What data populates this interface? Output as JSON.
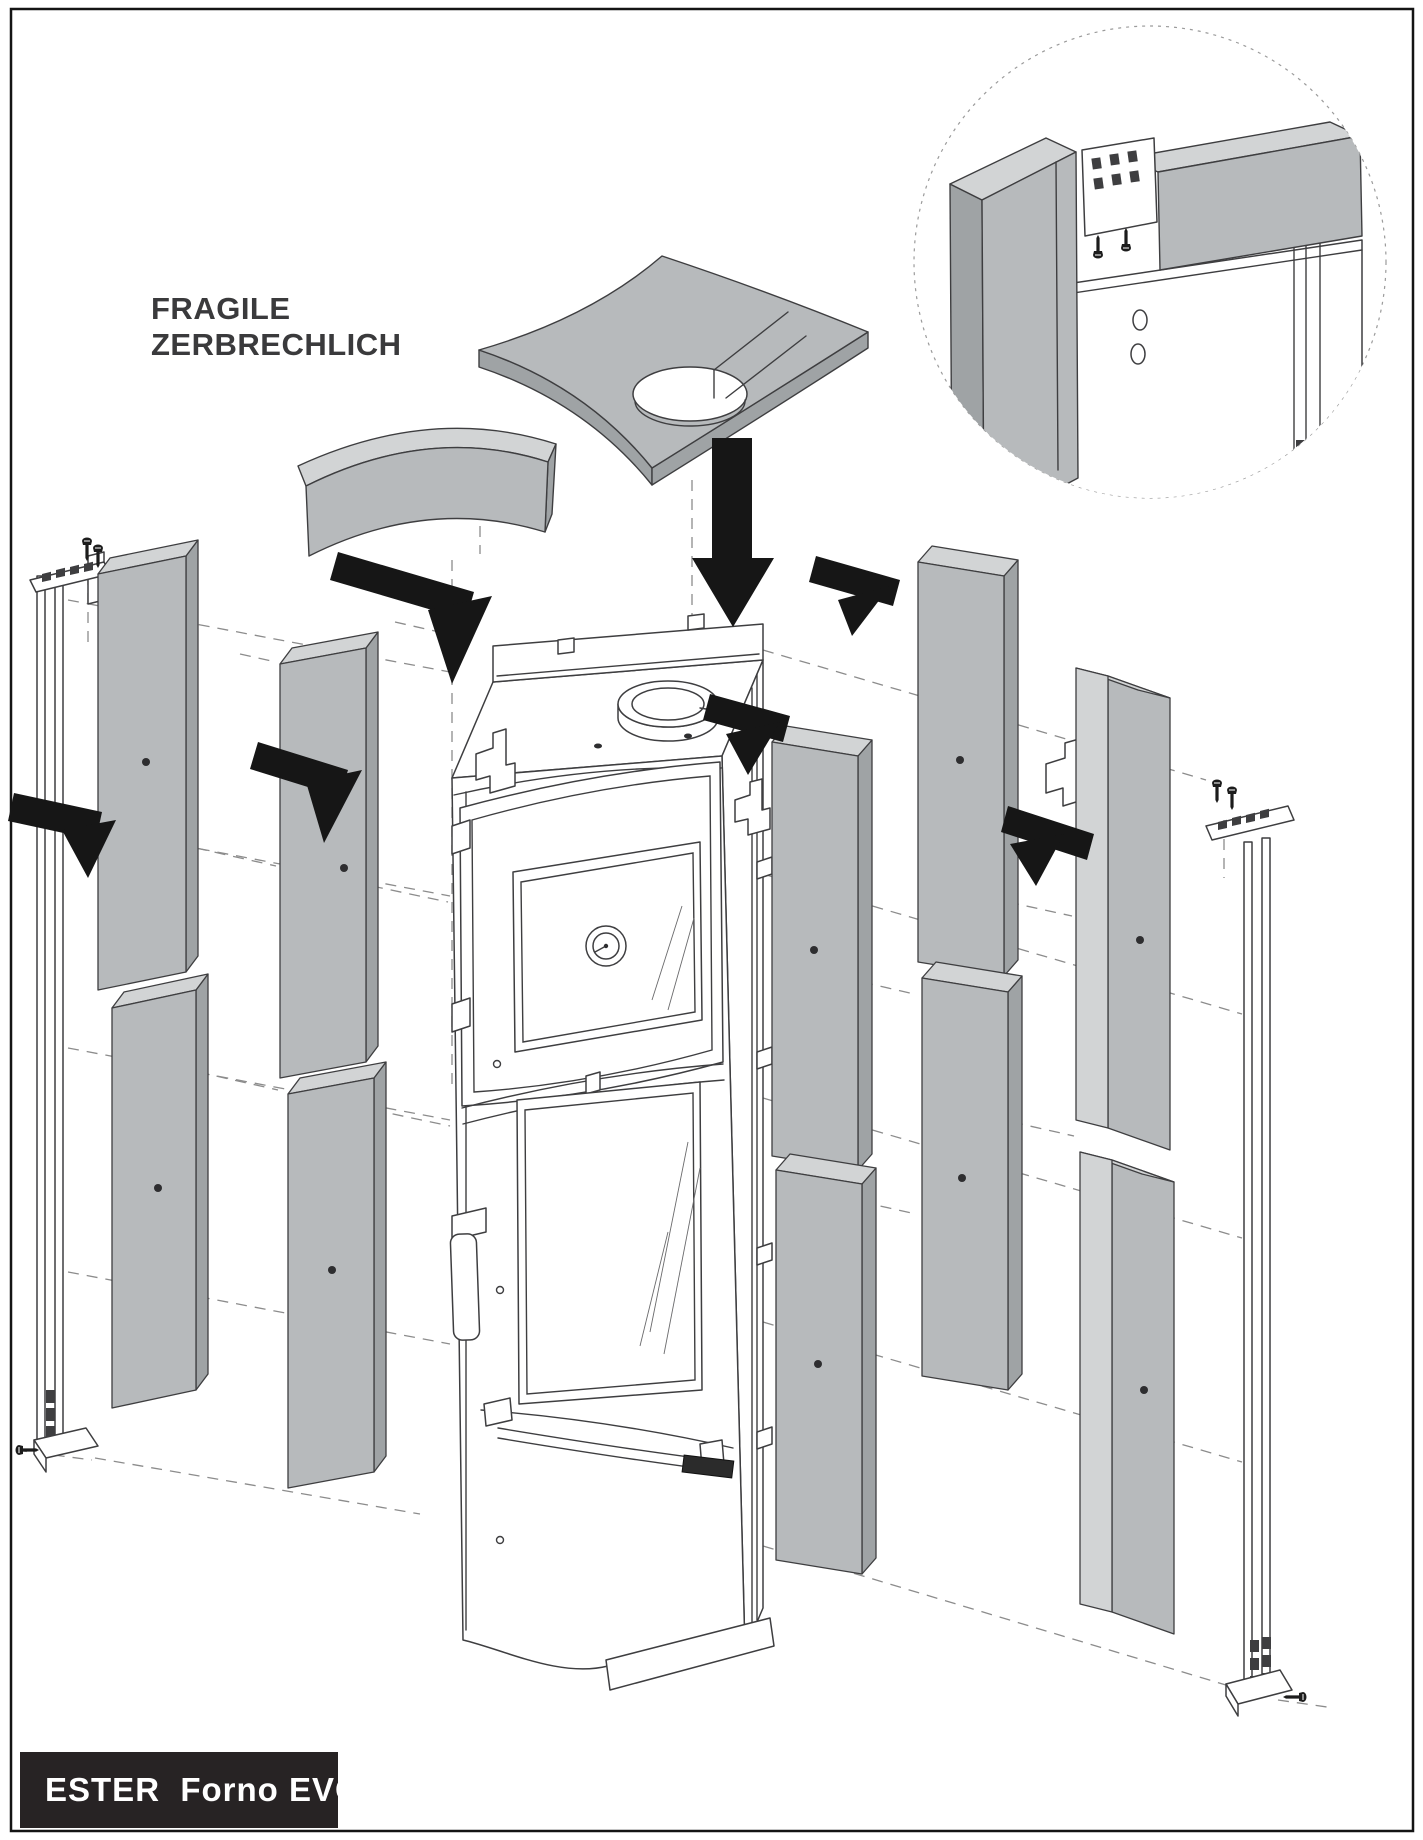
{
  "page": {
    "title_block": {
      "line1": "FRAGILE",
      "line2": "ZERBRECHLICH"
    },
    "model_label": {
      "text": "ESTER  Forno EVO"
    }
  },
  "colors": {
    "line": "#3e3e40",
    "dash": "#8c8c8c",
    "arrow": "#161616",
    "screw": "#1c1c1c",
    "panel-front": "#b7babc",
    "panel-top": "#d2d4d5",
    "panel-side": "#9fa3a5",
    "label-bg": "#272324",
    "label-text": "#ffffff",
    "fragile-text": "#3a3a3c",
    "bg": "#ffffff"
  },
  "diagram": {
    "parts": [
      "top-plate",
      "front-top-panel",
      "stove-body",
      "flue-collar",
      "oven-door",
      "thermometer-gauge",
      "lower-glass-door",
      "door-handle",
      "bottom-panel",
      "brand-plate",
      "left-mounting-rail",
      "right-mounting-rail",
      "ceramic-side-panels",
      "mounting-detail-circle"
    ],
    "side_panels": [
      {
        "name": "panel-left-outer-top",
        "x": 98,
        "y": 556,
        "w": 88,
        "h": 416,
        "tilt": 18,
        "dx": 12,
        "dy": -16,
        "dot": [
          146,
          762
        ]
      },
      {
        "name": "panel-left-outer-bottom",
        "x": 112,
        "y": 990,
        "w": 84,
        "h": 400,
        "tilt": 18,
        "dx": 12,
        "dy": -16,
        "dot": [
          158,
          1188
        ]
      },
      {
        "name": "panel-left-inner-top",
        "x": 280,
        "y": 648,
        "w": 86,
        "h": 414,
        "tilt": 16,
        "dx": 12,
        "dy": -16,
        "dot": [
          344,
          868
        ]
      },
      {
        "name": "panel-left-inner-bottom",
        "x": 288,
        "y": 1078,
        "w": 86,
        "h": 394,
        "tilt": 16,
        "dx": 12,
        "dy": -16,
        "dot": [
          332,
          1270
        ]
      },
      {
        "name": "panel-right-inner-top",
        "x": 772,
        "y": 742,
        "w": 86,
        "h": 414,
        "tilt": -14,
        "dx": 14,
        "dy": -16,
        "dot": [
          814,
          950
        ]
      },
      {
        "name": "panel-right-inner-bottom",
        "x": 776,
        "y": 1170,
        "w": 86,
        "h": 390,
        "tilt": -14,
        "dx": 14,
        "dy": -16,
        "dot": [
          818,
          1364
        ]
      },
      {
        "name": "panel-right-mid-top",
        "x": 918,
        "y": 562,
        "w": 86,
        "h": 400,
        "tilt": -14,
        "dx": 14,
        "dy": -16,
        "dot": [
          960,
          760
        ]
      },
      {
        "name": "panel-right-mid-bottom",
        "x": 922,
        "y": 978,
        "w": 86,
        "h": 398,
        "tilt": -14,
        "dx": 14,
        "dy": -16,
        "dot": [
          962,
          1178
        ]
      },
      {
        "name": "panel-right-outer-top",
        "x": 1076,
        "y": 668,
        "w": 32,
        "h": 452,
        "tilt": -8,
        "dx": 62,
        "dy": 22,
        "edge": true,
        "dot": [
          1140,
          940
        ]
      },
      {
        "name": "panel-right-outer-bottom",
        "x": 1080,
        "y": 1152,
        "w": 32,
        "h": 452,
        "tilt": -8,
        "dx": 62,
        "dy": 22,
        "edge": true,
        "dot": [
          1144,
          1390
        ]
      }
    ],
    "arrows": [
      {
        "name": "arrow-down-top",
        "polys": [
          "712,438 752,438 752,558 774,558 733,627 692,558 712,558"
        ]
      },
      {
        "name": "arrow-left-upper",
        "polys": [
          "338,552 474,592 466,620 330,580",
          "428,610 492,596 452,684"
        ]
      },
      {
        "name": "arrow-far-left",
        "polys": [
          "14,793 102,812 96,840 8,821",
          "62,830 116,820 88,878"
        ]
      },
      {
        "name": "arrow-left-inner",
        "polys": [
          "258,742 348,770 340,797 250,769",
          "306,782 362,770 324,843"
        ]
      },
      {
        "name": "arrow-center-right",
        "polys": [
          "710,694 790,716 783,742 703,720",
          "726,734 780,722 748,775"
        ]
      },
      {
        "name": "arrow-right-upper",
        "polys": [
          "816,556 900,580 893,606 809,582",
          "838,600 890,586 852,636"
        ]
      },
      {
        "name": "arrow-far-right",
        "polys": [
          "1008,806 1094,834 1087,860 1001,832",
          "1010,844 1064,834 1036,886"
        ]
      }
    ],
    "screws": [
      {
        "x": 87,
        "y": 544,
        "rot": 0
      },
      {
        "x": 98,
        "y": 551,
        "rot": 0
      },
      {
        "x": 22,
        "y": 1450,
        "rot": -90
      },
      {
        "x": 1217,
        "y": 786,
        "rot": 0
      },
      {
        "x": 1232,
        "y": 793,
        "rot": 0
      },
      {
        "x": 1300,
        "y": 1697,
        "rot": 90
      },
      {
        "x": 1098,
        "y": 252,
        "rot": 180
      },
      {
        "x": 1126,
        "y": 245,
        "rot": 180
      }
    ],
    "dashed_lines": [
      [
        480,
        488,
        480,
        554
      ],
      [
        452,
        560,
        452,
        1086
      ],
      [
        692,
        480,
        692,
        958
      ],
      [
        68,
        600,
        450,
        672
      ],
      [
        68,
        824,
        450,
        896
      ],
      [
        68,
        1048,
        450,
        1120
      ],
      [
        68,
        1272,
        450,
        1344
      ],
      [
        95,
        1458,
        420,
        1514
      ],
      [
        763,
        650,
        1206,
        780
      ],
      [
        763,
        874,
        1242,
        1014
      ],
      [
        763,
        1098,
        1242,
        1238
      ],
      [
        763,
        1322,
        1242,
        1462
      ],
      [
        763,
        1546,
        1236,
        1688
      ],
      [
        88,
        574,
        88,
        648
      ],
      [
        1224,
        820,
        1224,
        878
      ],
      [
        16,
        1450,
        92,
        1460
      ],
      [
        1278,
        1700,
        1334,
        1708
      ],
      [
        196,
        848,
        276,
        866
      ],
      [
        198,
        1072,
        278,
        1090
      ],
      [
        372,
        886,
        448,
        902
      ],
      [
        374,
        1110,
        450,
        1126
      ],
      [
        862,
        982,
        914,
        994
      ],
      [
        862,
        1202,
        916,
        1214
      ],
      [
        1008,
        902,
        1072,
        916
      ],
      [
        1012,
        1122,
        1074,
        1136
      ],
      [
        240,
        654,
        276,
        662
      ],
      [
        395,
        622,
        448,
        634
      ]
    ]
  }
}
